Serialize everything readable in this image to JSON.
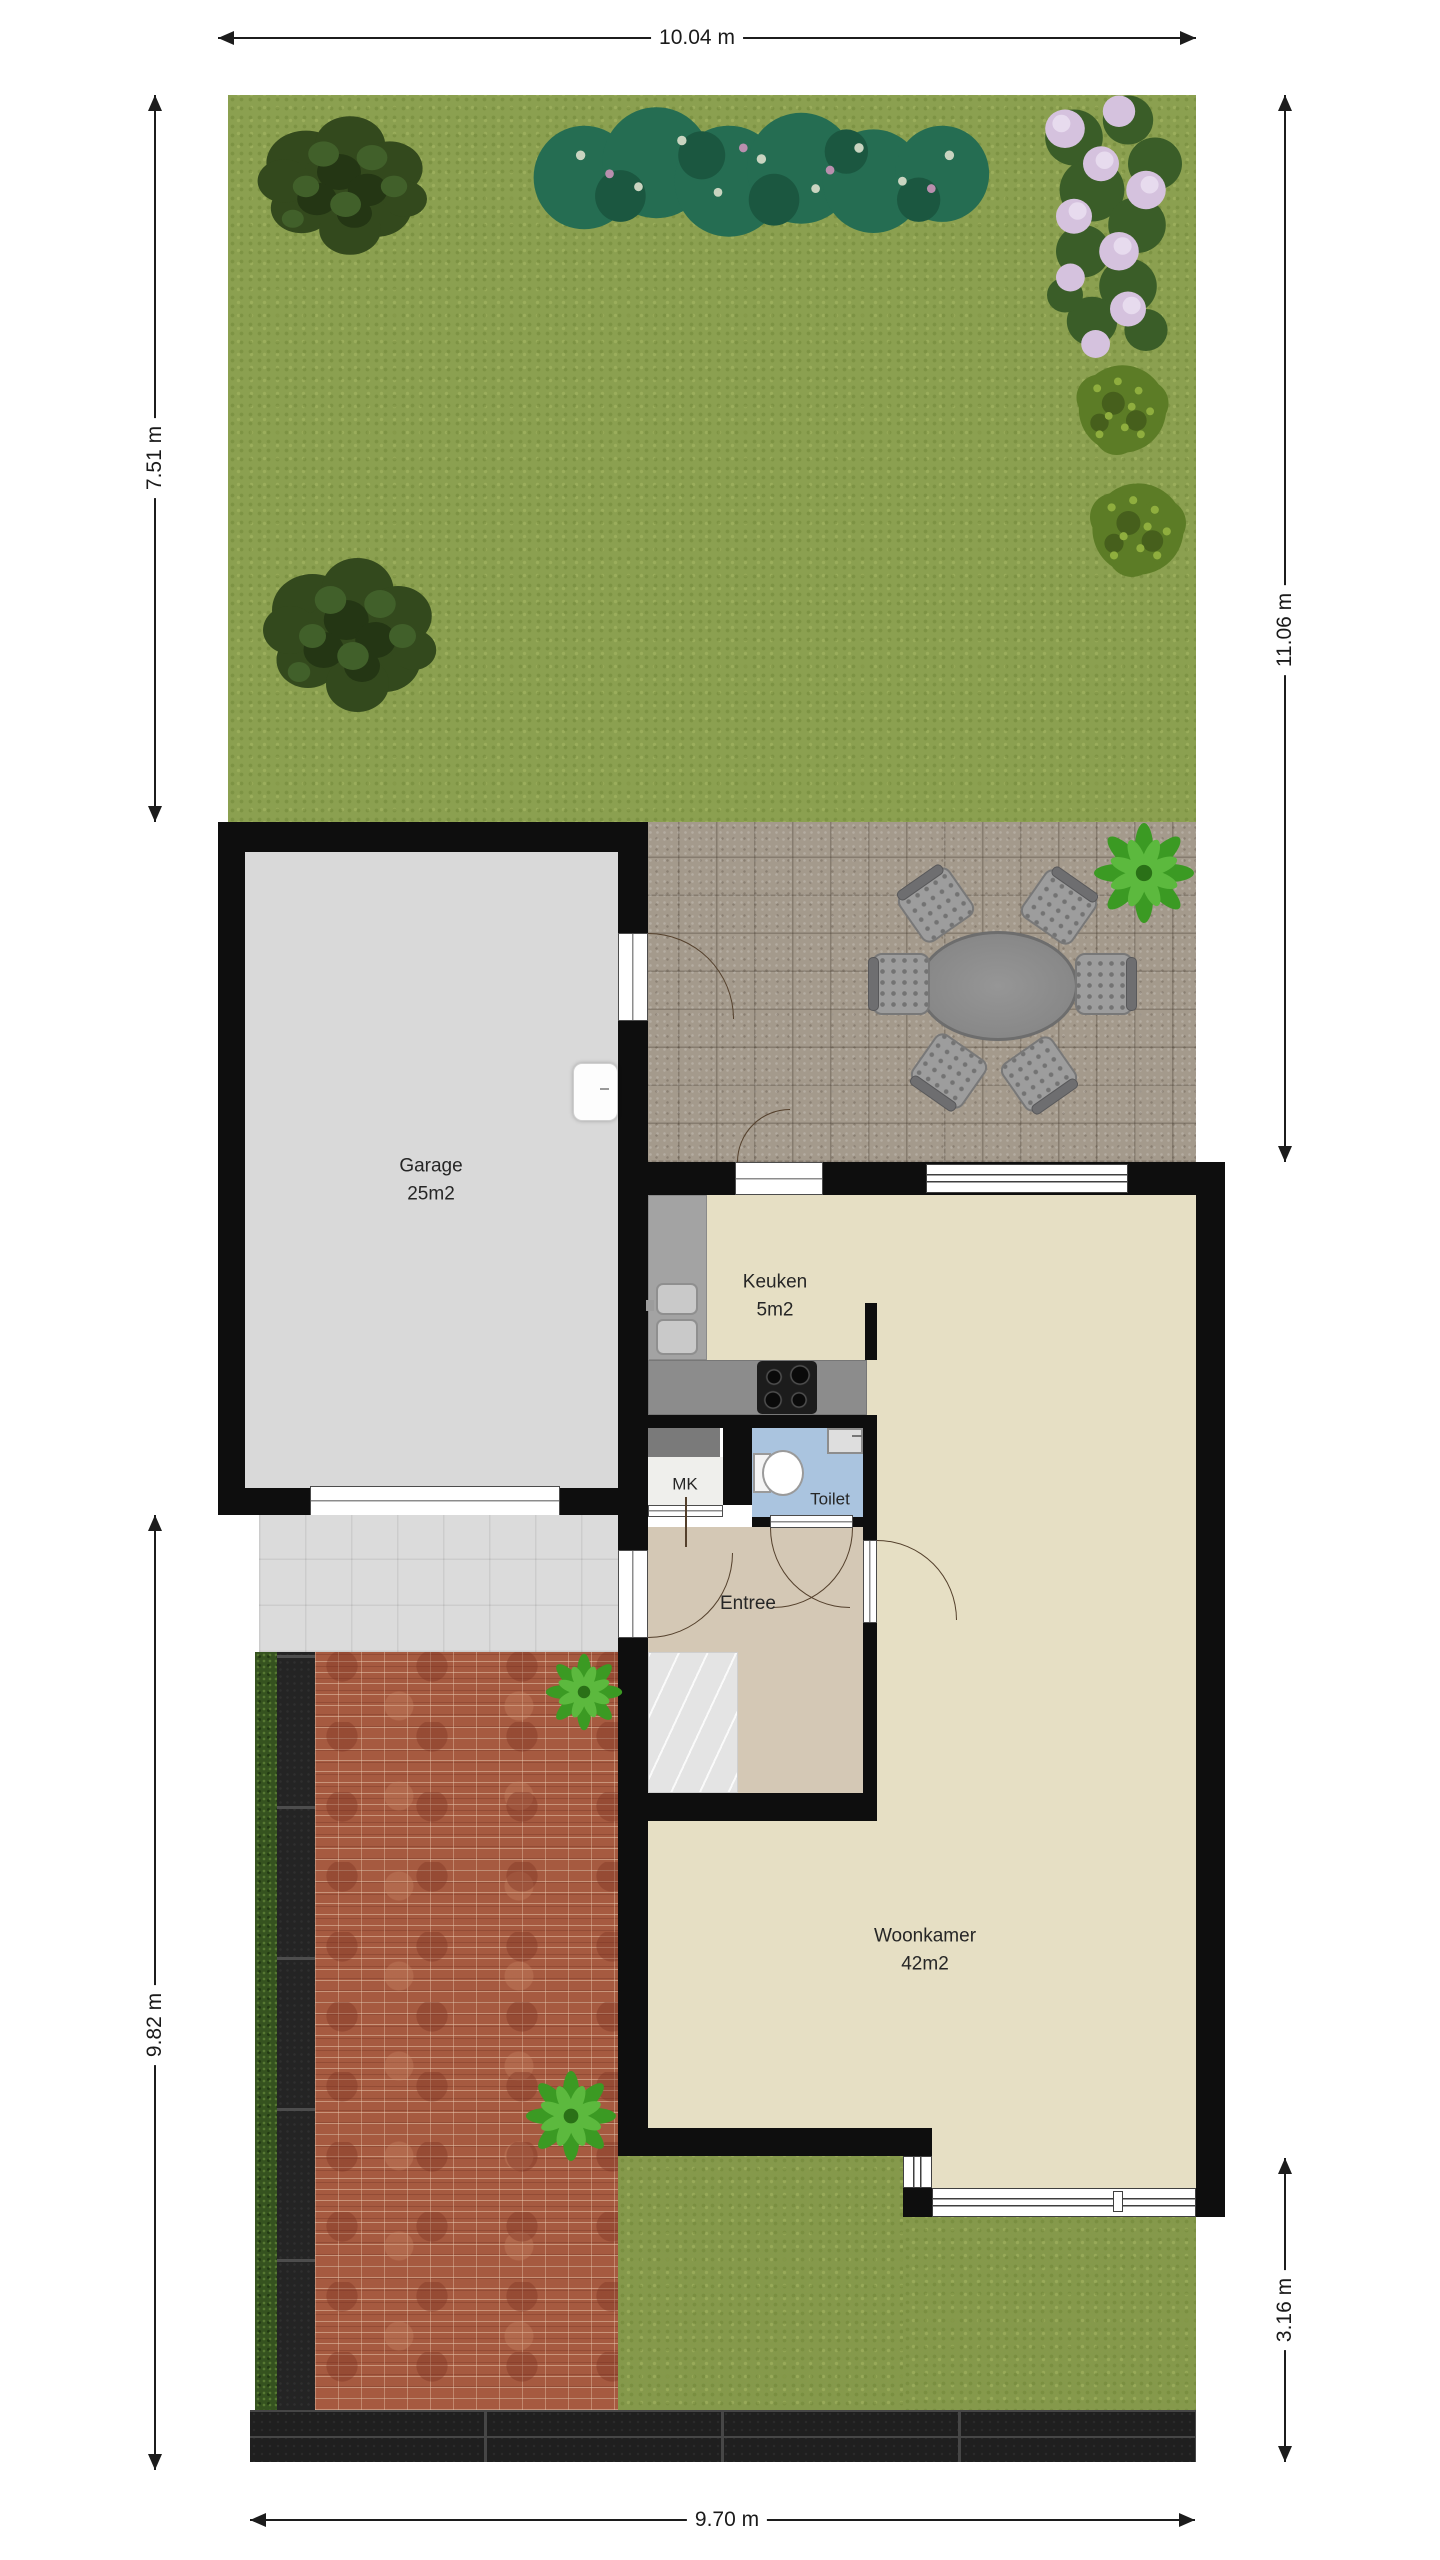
{
  "plan": {
    "rooms": [
      {
        "id": "garage",
        "name": "Garage",
        "area": "25m2"
      },
      {
        "id": "keuken",
        "name": "Keuken",
        "area": "5m2"
      },
      {
        "id": "toilet",
        "name": "Toilet",
        "area": ""
      },
      {
        "id": "mk",
        "name": "MK",
        "area": ""
      },
      {
        "id": "entree",
        "name": "Entree",
        "area": ""
      },
      {
        "id": "woonkamer",
        "name": "Woonkamer",
        "area": "42m2"
      }
    ],
    "dimensions": {
      "top": "10.04 m",
      "garden_left": "7.51 m",
      "right": "11.06 m",
      "front_left": "9.82 m",
      "front_right": "3.16 m",
      "bottom": "9.70 m"
    },
    "colors": {
      "grass": "#8ba050",
      "patio": "#a49a8c",
      "garage_floor": "#d9d9d9",
      "room_floor": "#e6dfc4",
      "entree_floor": "#d4c8b5",
      "toilet_floor": "#aac4df",
      "wall": "#0e0e0e",
      "brick": "#a65a40"
    }
  }
}
